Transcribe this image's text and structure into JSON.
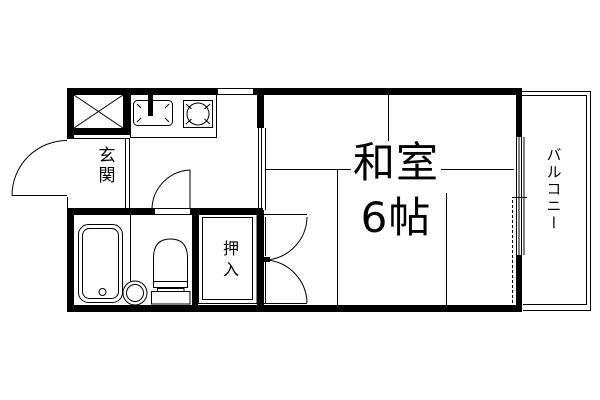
{
  "document": {
    "type": "apartment-floor-plan"
  },
  "colors": {
    "line": "#000000",
    "background": "#ffffff"
  },
  "rooms": {
    "washitsu": {
      "name": "和室",
      "size": "6帖"
    },
    "genkan": {
      "label": "玄関"
    },
    "oshiire": {
      "label": "押入"
    },
    "balcony": {
      "label": "バルコニー"
    }
  },
  "fixtures": {
    "meter_box": "crossed-box",
    "kitchen_sink": "sink-with-faucet",
    "stove": "round-burner",
    "bathtub": "bathtub",
    "wash_basin": "round-basin",
    "toilet": "toilet"
  }
}
